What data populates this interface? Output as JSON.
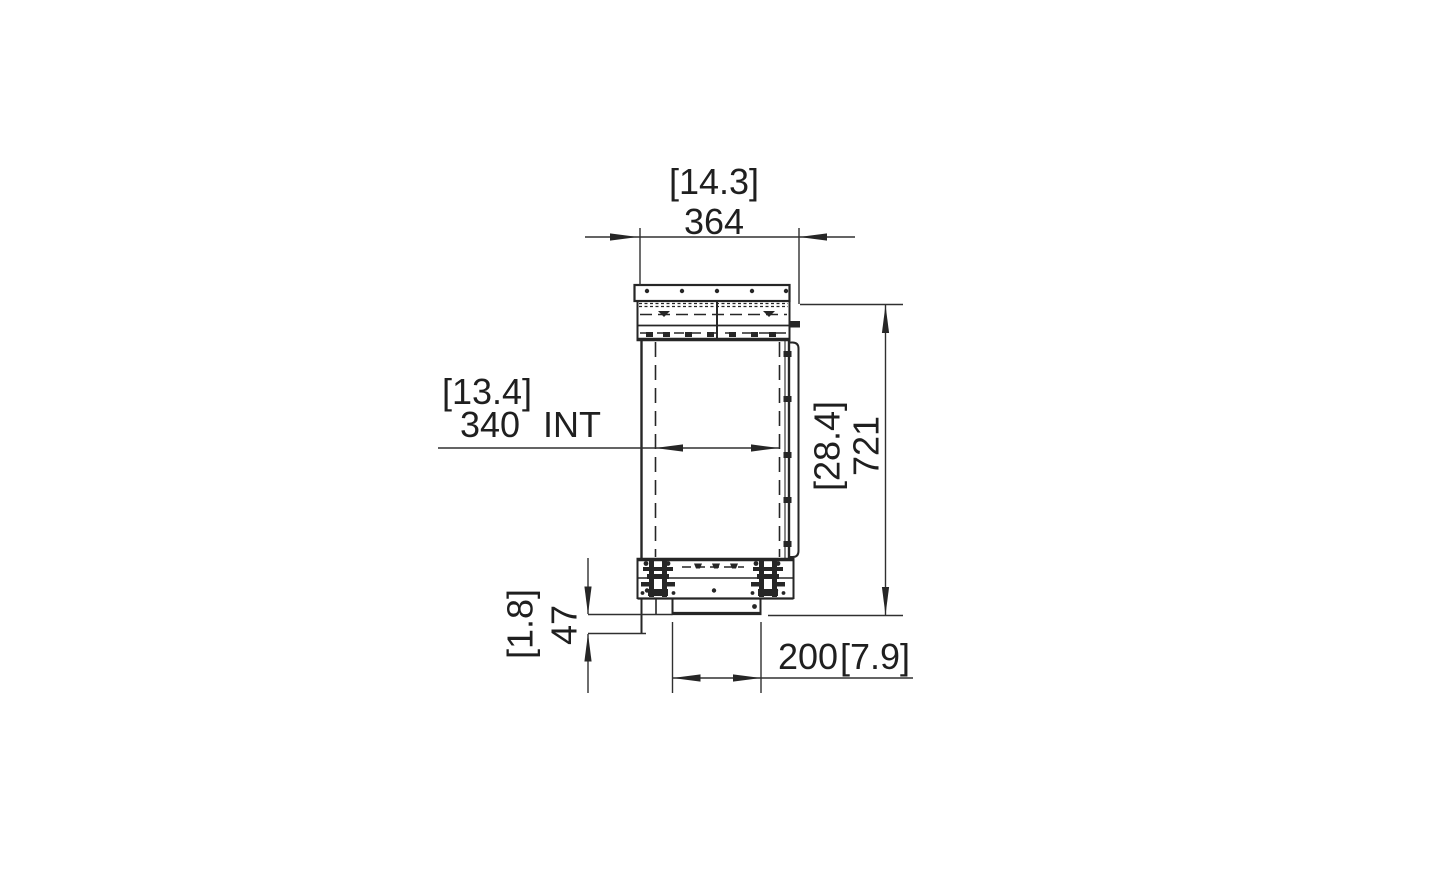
{
  "drawing": {
    "view": "firebox-side-section",
    "line_color": "#262626",
    "background": "#ffffff"
  },
  "dimensions": {
    "overall_width": {
      "metric": "364",
      "imperial": "[14.3]"
    },
    "internal_width": {
      "metric": "340",
      "unit_label": "INT",
      "imperial": "[13.4]"
    },
    "overall_height": {
      "metric": "721",
      "imperial": "[28.4]"
    },
    "base_height": {
      "metric": "47",
      "imperial": "[1.8]"
    },
    "base_depth": {
      "metric": "200",
      "imperial": "[7.9]"
    }
  }
}
